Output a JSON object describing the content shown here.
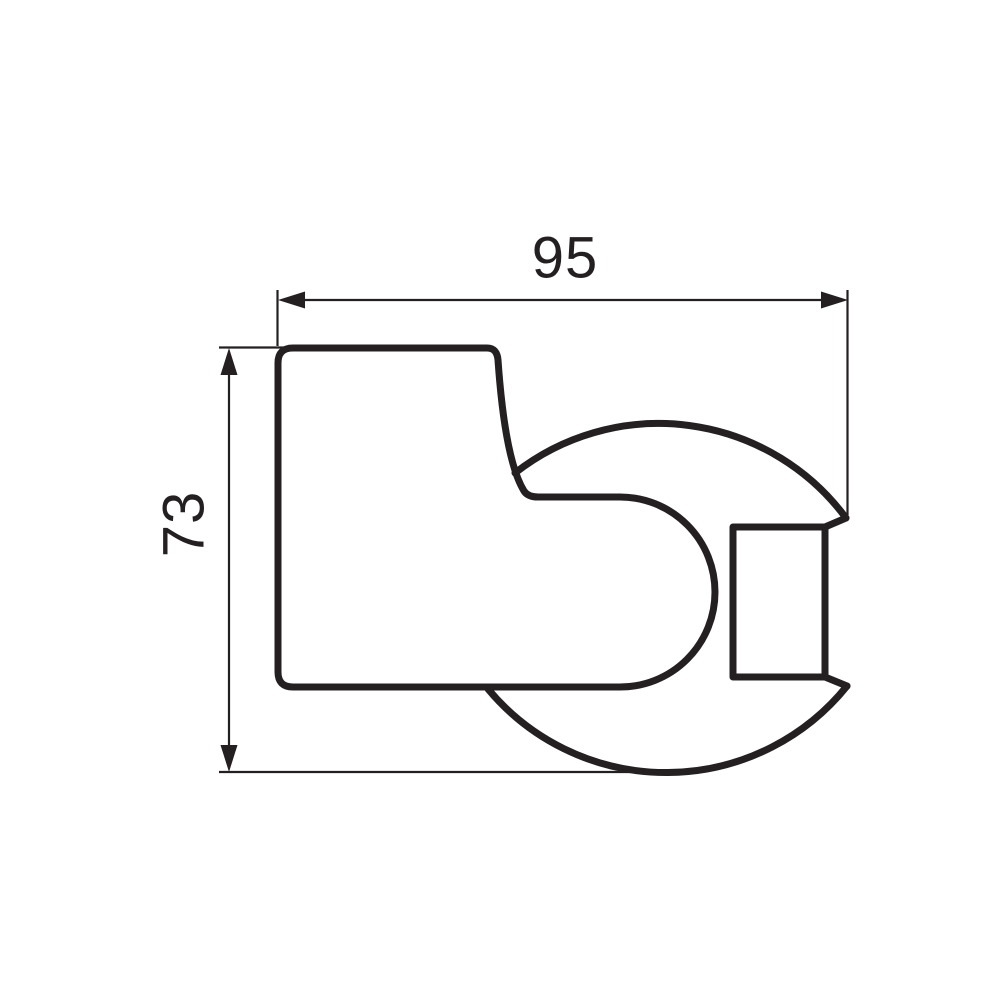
{
  "colors": {
    "line": "#242021",
    "background": "#ffffff"
  },
  "dimensions": {
    "width": {
      "label": "95"
    },
    "height": {
      "label": "73"
    }
  }
}
